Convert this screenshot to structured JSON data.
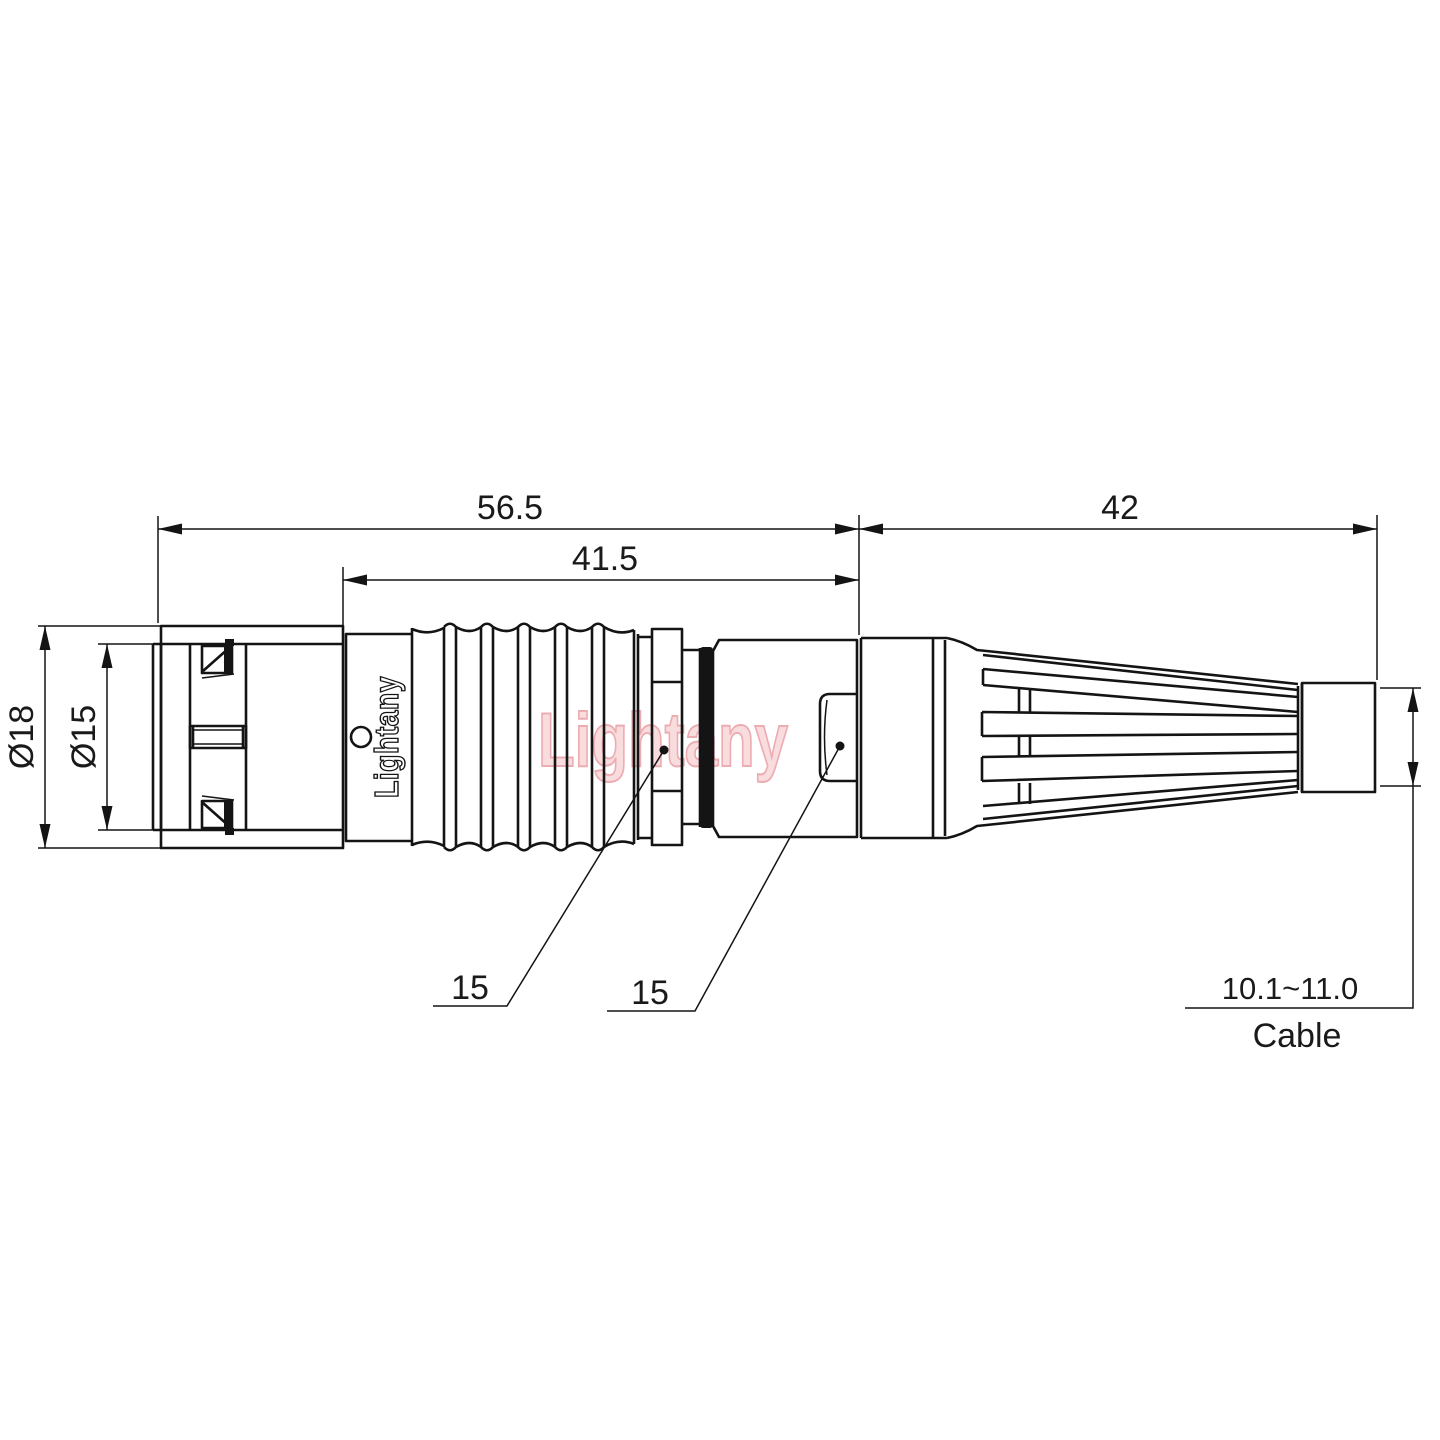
{
  "watermark": {
    "text": "Lightany"
  },
  "part": {
    "brand": "Lightany"
  },
  "dims": {
    "overall": "56.5",
    "body": "41.5",
    "boot": "42",
    "dia_outer": "Ø18",
    "dia_inner": "Ø15",
    "flats_front": "15",
    "flats_back": "15",
    "cable_range": "10.1~11.0",
    "cable_label": "Cable"
  }
}
